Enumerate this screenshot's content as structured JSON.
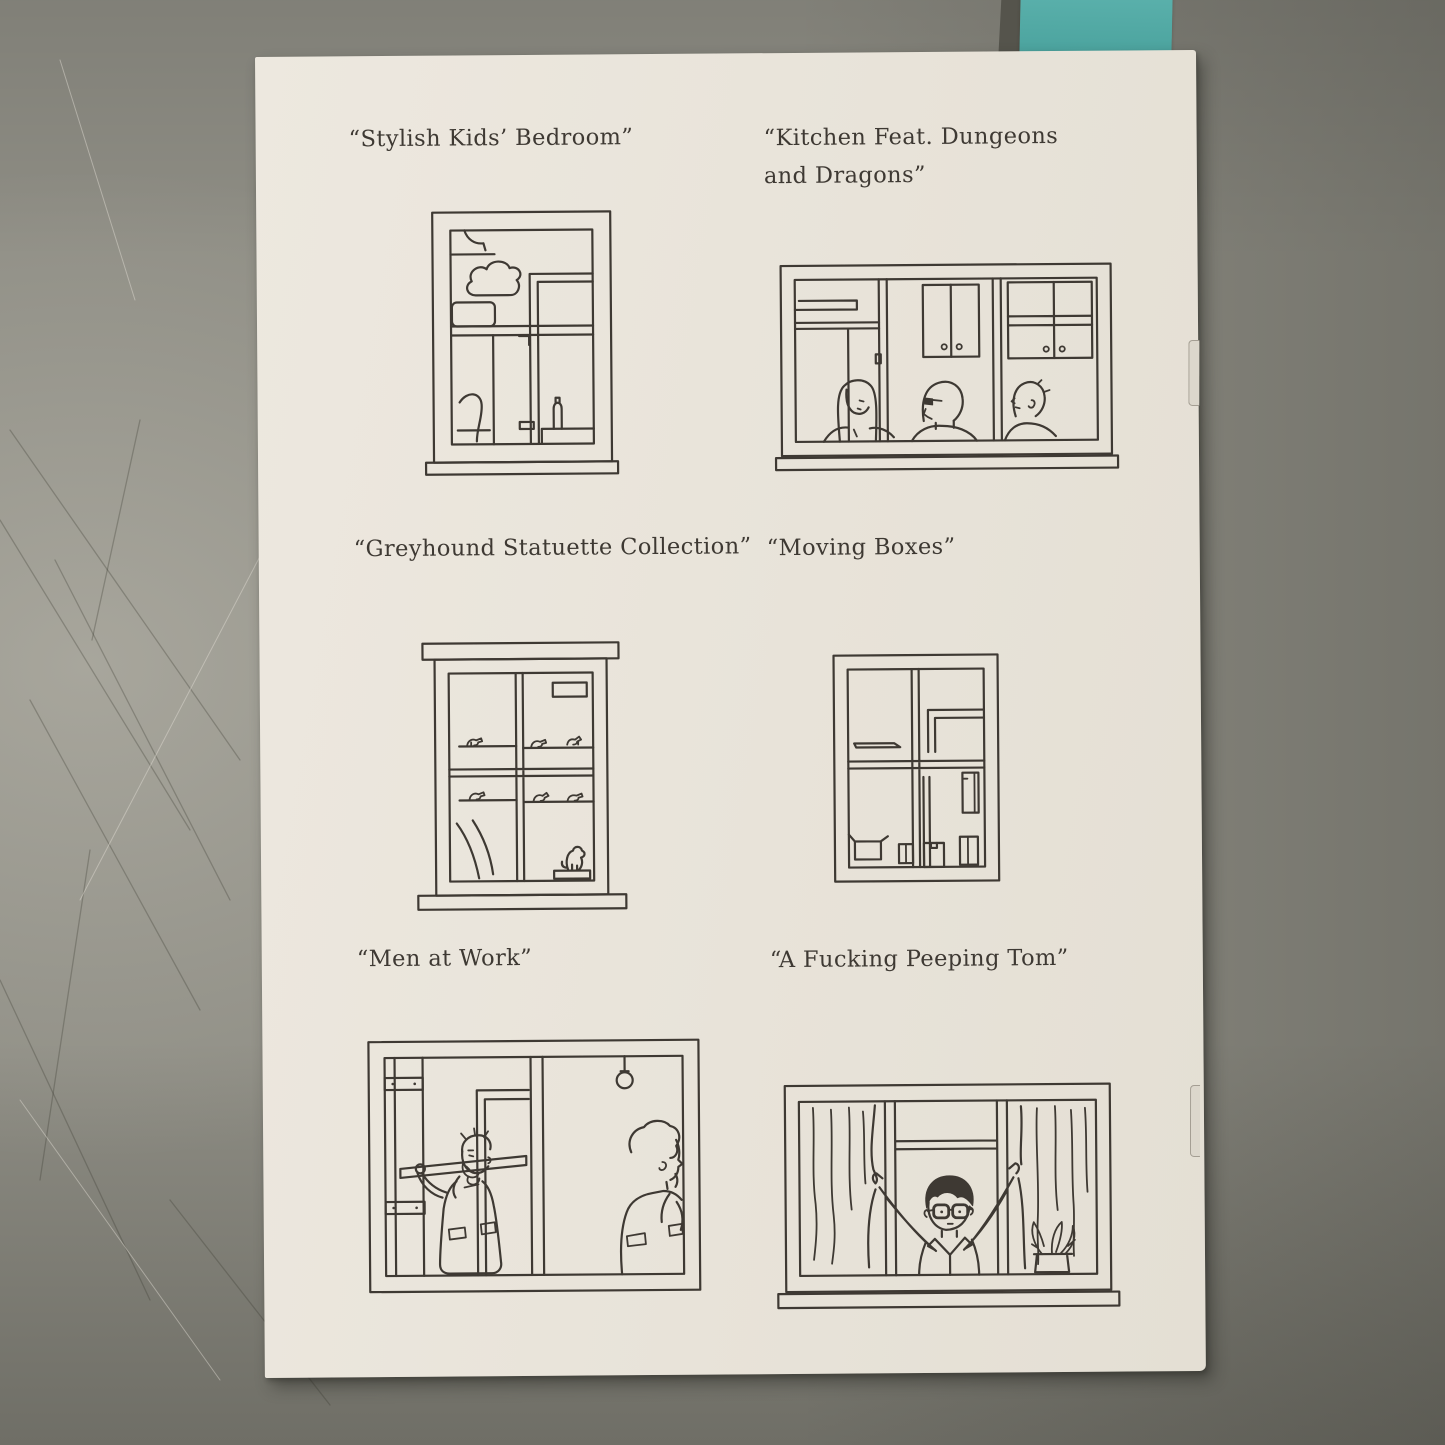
{
  "colors": {
    "surface": "#8f8e85",
    "page-bg": "#e8e3d9",
    "ink": "#3e3933",
    "bookmark": "#4aa29d"
  },
  "scene": {
    "description": "Photograph of a stapled zine page on a scratched gray table, teal bookmark tucked behind the top edge",
    "bookmark": "teal-bookmark"
  },
  "page": {
    "items": [
      {
        "id": "kids-bedroom",
        "caption": "“Stylish Kids’ Bedroom”",
        "illustration": "tall window showing a kids bedroom with cloud wall decal, picture frame, wardrobe and bottle on a ledge"
      },
      {
        "id": "kitchen-dnd",
        "caption": "“Kitchen Feat. Dungeons and Dragons”",
        "illustration": "wide kitchen window with upper cabinets and three people sitting around a table"
      },
      {
        "id": "greyhound",
        "caption": "“Greyhound Statuette Collection”",
        "illustration": "window with cross mullion, shelves of small greyhound statuettes, curtain and a sitting dog figurine"
      },
      {
        "id": "moving-boxes",
        "caption": "“Moving Boxes”",
        "illustration": "window with cross mullion, empty shelf and stacked cardboard moving boxes"
      },
      {
        "id": "men-at-work",
        "caption": "“Men at Work”",
        "illustration": "wide window with bare bulb, wall studs and two workmen, one carrying a plank"
      },
      {
        "id": "peeping-tom",
        "caption": "“A Fucking Peeping Tom”",
        "illustration": "wide window with curtains thrown open by a black-haired man in glasses, potted plant on the sill"
      }
    ]
  }
}
